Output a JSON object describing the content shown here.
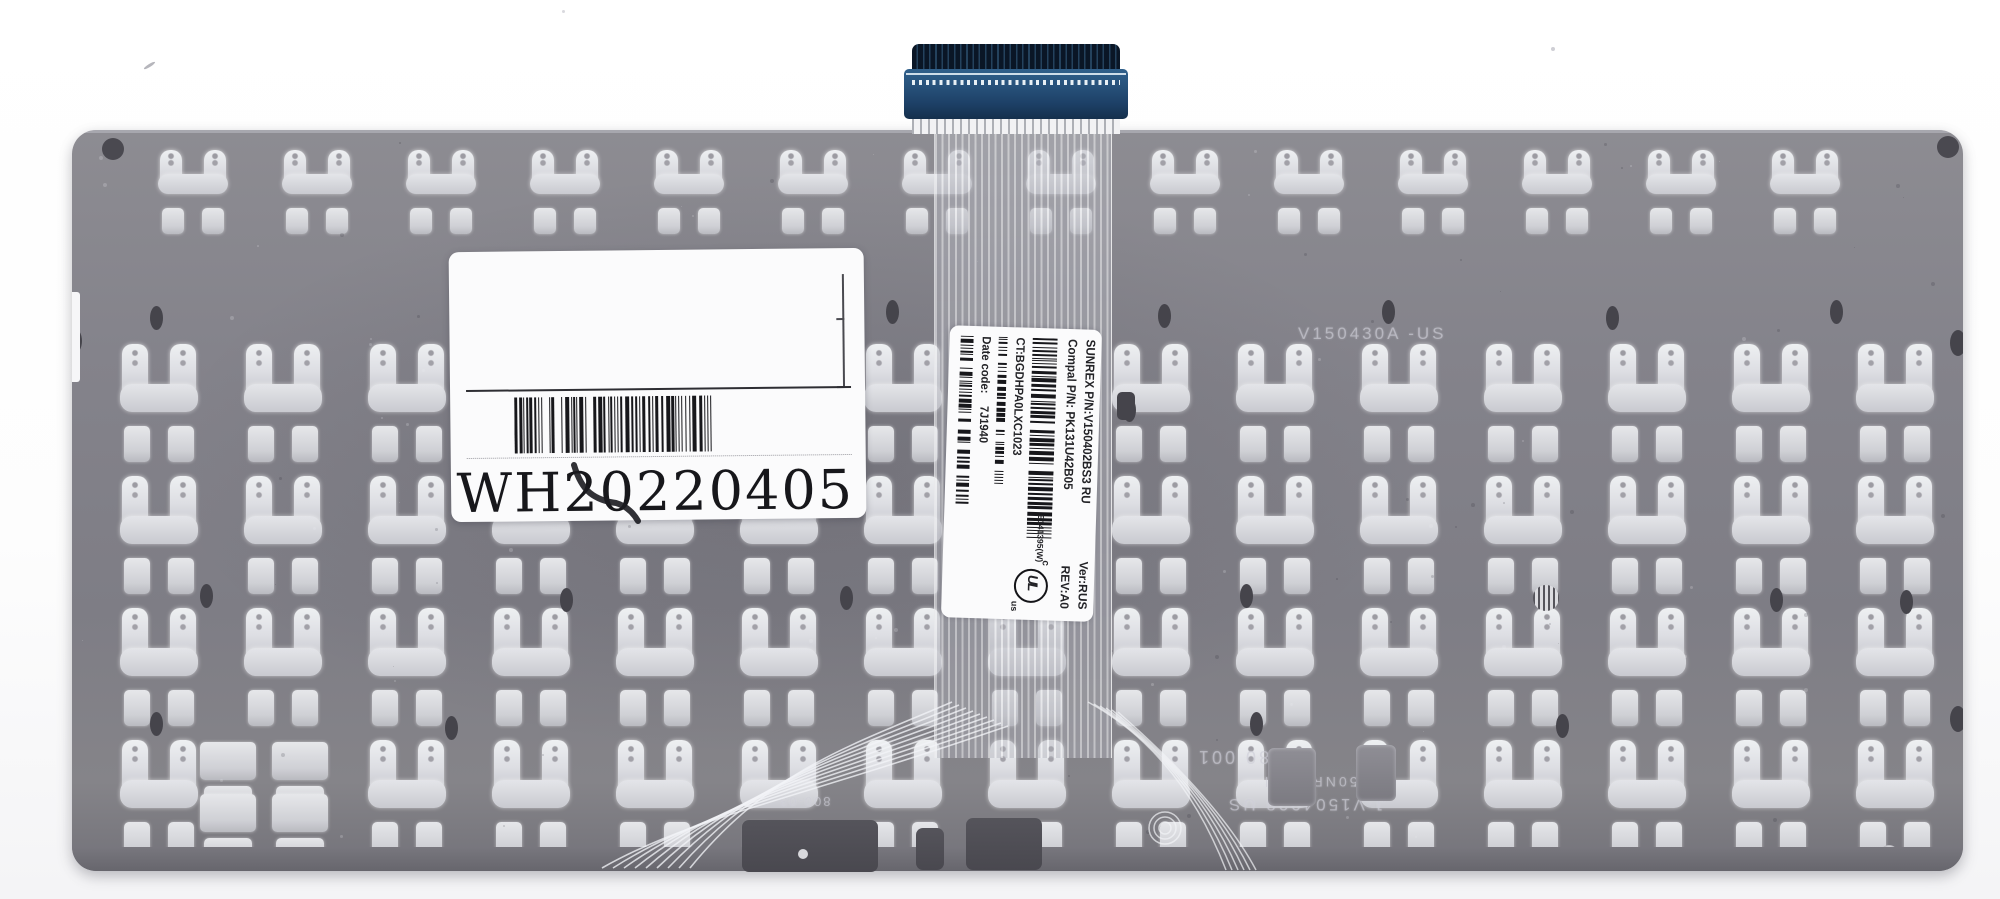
{
  "colors": {
    "plate_gray": "#84838b",
    "cutout_white": "#e6e7ea",
    "connector_navy": "#152f4c",
    "connector_face": "#2a5884",
    "label_white": "#fbfbfc",
    "print_black": "#17171b",
    "cable_stripe": "#b0b2b8"
  },
  "stickers": {
    "date_label": {
      "code": "WH20220405",
      "barcode_icon": "barcode"
    },
    "ribbon_label": {
      "sunrex_pn": "SUNREX P/N:V150402BS3 RU",
      "ver": "Ver:RUS",
      "compal_pn": "Compal P/N: PK131U42B05",
      "rev": "REV:A0",
      "ct": "CT:BGDHPA0LXC1023",
      "date_code_label": "Date code:",
      "date_code_value": "7J1940",
      "ul_prefix": "c",
      "ul_letters": "UL",
      "ul_suffix": "us",
      "ul_file_number": "E141395(W)",
      "barcode_icon": "barcode"
    }
  },
  "etched_markings": {
    "plate_top_right": "V150430A -US",
    "bottom_flipped_1": "180 001",
    "bottom_flipped_2": "50NR1-1Al",
    "bottom_flipped_3": "J·V1504028 US",
    "bottom_flipped_4": "800-03"
  }
}
